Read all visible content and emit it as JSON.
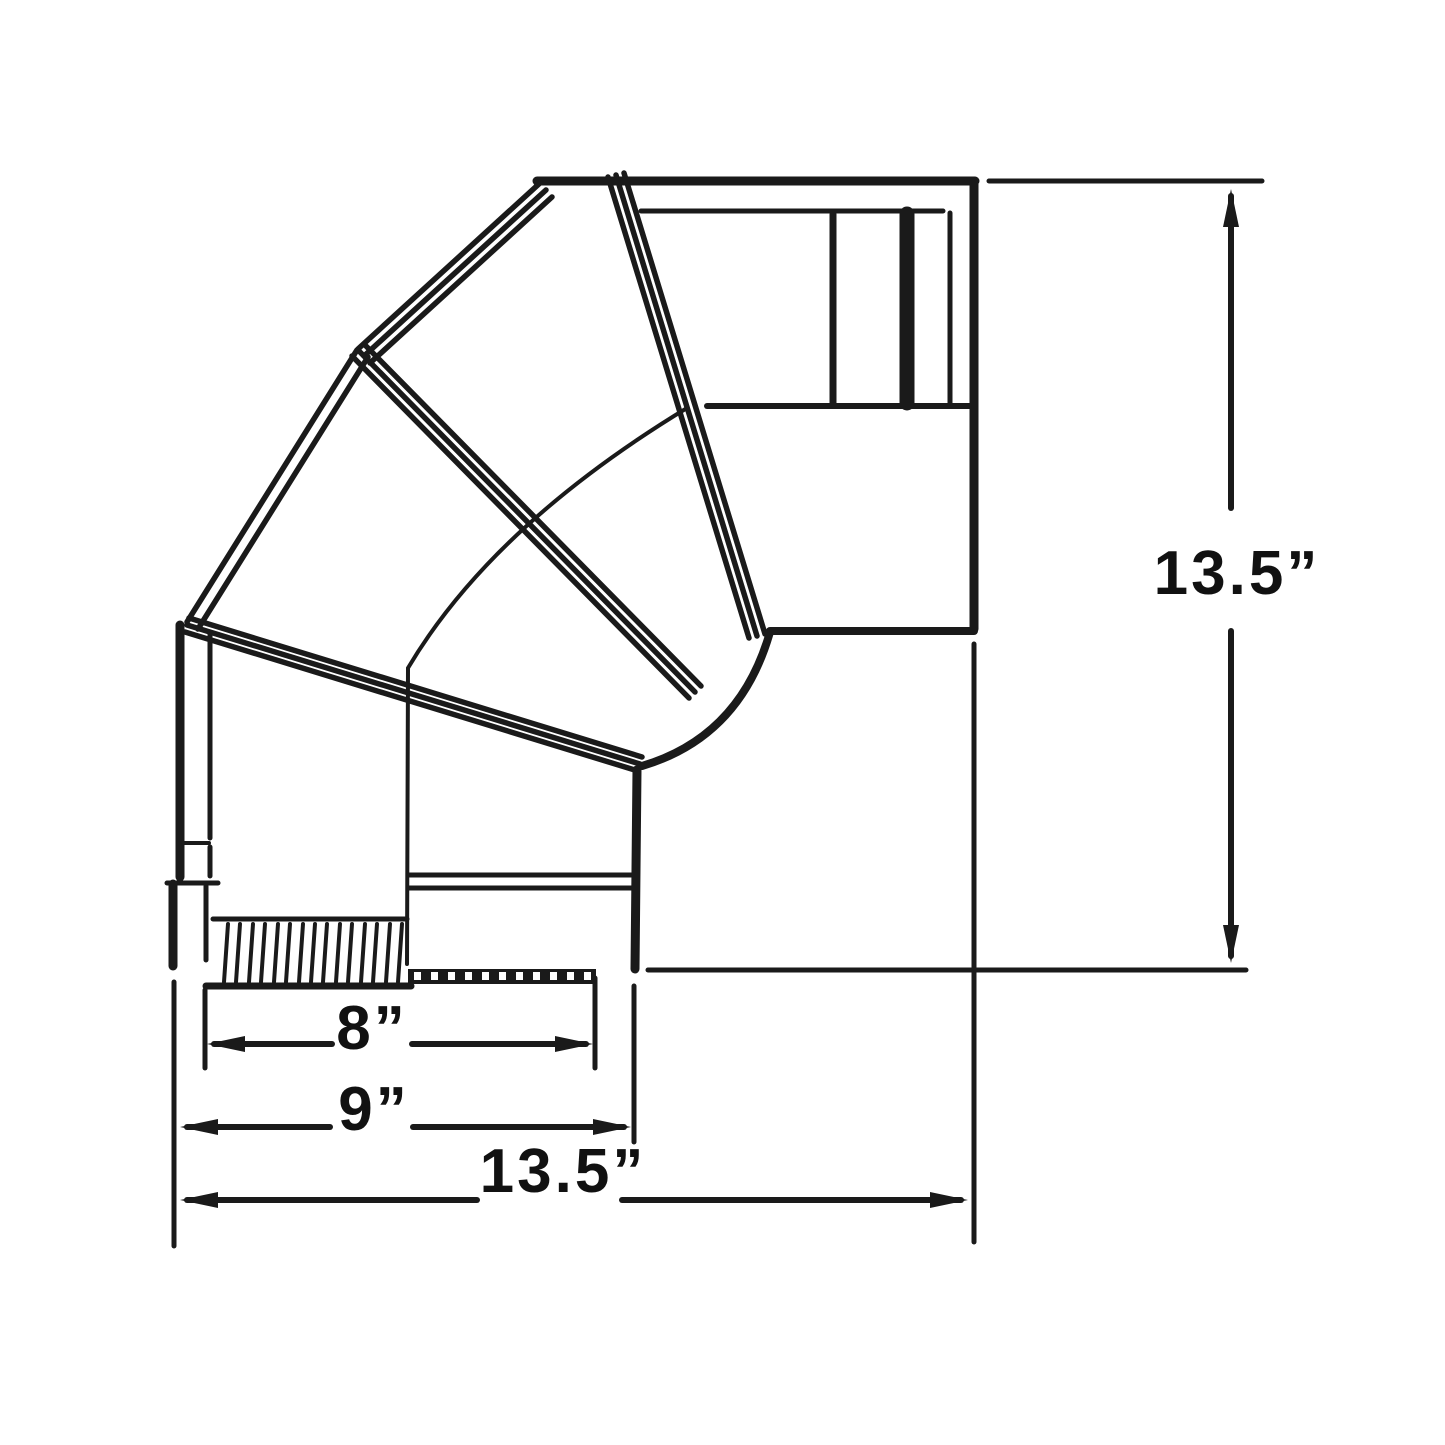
{
  "drawing": {
    "name": "stove-pipe-90-degree-adjustable-elbow-dimension-diagram",
    "background_color": "#ffffff",
    "line_color": "#1a1a1a",
    "dimensions": {
      "inner_width": {
        "label": "8”",
        "value_in": 8
      },
      "outer_width": {
        "label": "9”",
        "value_in": 9
      },
      "total_width": {
        "label": "13.5”",
        "value_in": 13.5
      },
      "total_height": {
        "label": "13.5”",
        "value_in": 13.5
      }
    }
  }
}
